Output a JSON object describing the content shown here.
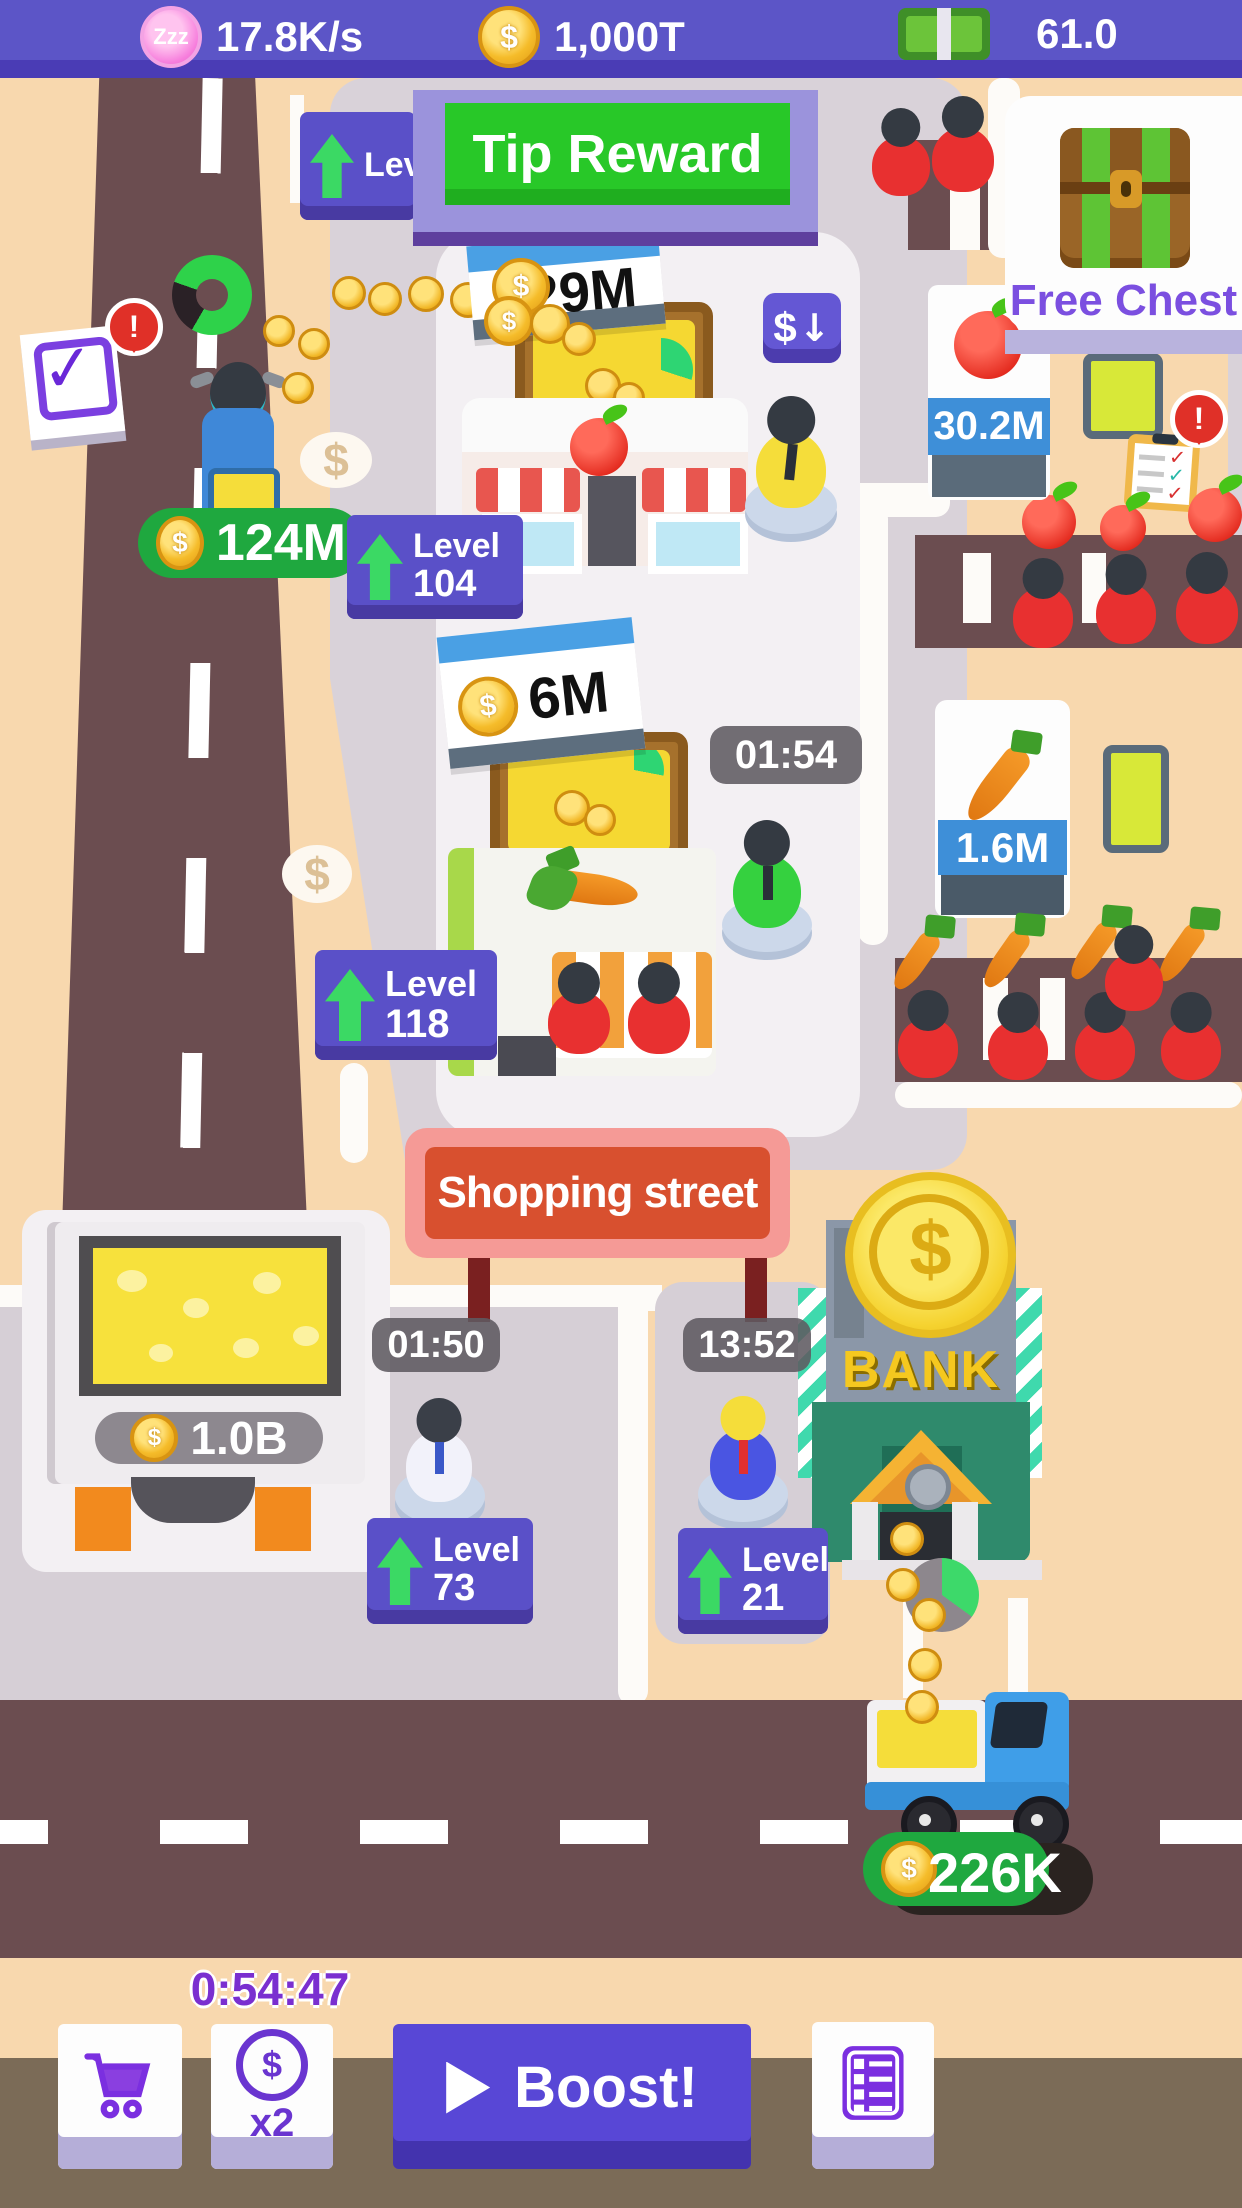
{
  "status_bar": {
    "income_rate": "17.8K/s",
    "coins": "1,000T",
    "add": "+",
    "cash": "61.0"
  },
  "banners": {
    "tip_reward": "Tip Reward",
    "free_chest": "Free Chest",
    "street_sign": "Shopping street"
  },
  "labels": {
    "level": "Level"
  },
  "symbols": {
    "dollar": "$",
    "down_arrow": "↓",
    "play": "",
    "alert": "!",
    "check": "✓",
    "zzz": "Zzz"
  },
  "shops": {
    "candy_shop": {
      "sign_value": "329M",
      "level": "104"
    },
    "veggie_shop": {
      "sign_value": "6M",
      "level": "118",
      "timer": "01:54"
    },
    "cheese_factory": {
      "stored_value": "1.0B",
      "level": "73",
      "timer": "01:50"
    },
    "bank": {
      "name": "BANK",
      "level": "21",
      "timer": "13:52"
    }
  },
  "stands": {
    "apple_stand_value": "30.2M",
    "carrot_stand_value": "1.6M"
  },
  "vehicles": {
    "scooter_value": "124M",
    "truck_value": "226K"
  },
  "footer": {
    "boost_timer": "0:54:47",
    "multiplier": "x2",
    "boost_label": "Boost!"
  },
  "colors": {
    "top_bar": "#5c55c7",
    "ui_purple": "#5a50c8",
    "accent_green": "#23ab41",
    "tip_green": "#28c828",
    "road": "#6b4d50",
    "background_tan": "#f8d8ae",
    "sign_red": "#d8502f",
    "bank_green": "#2f8a6c",
    "money_green": "#6cc43a"
  }
}
